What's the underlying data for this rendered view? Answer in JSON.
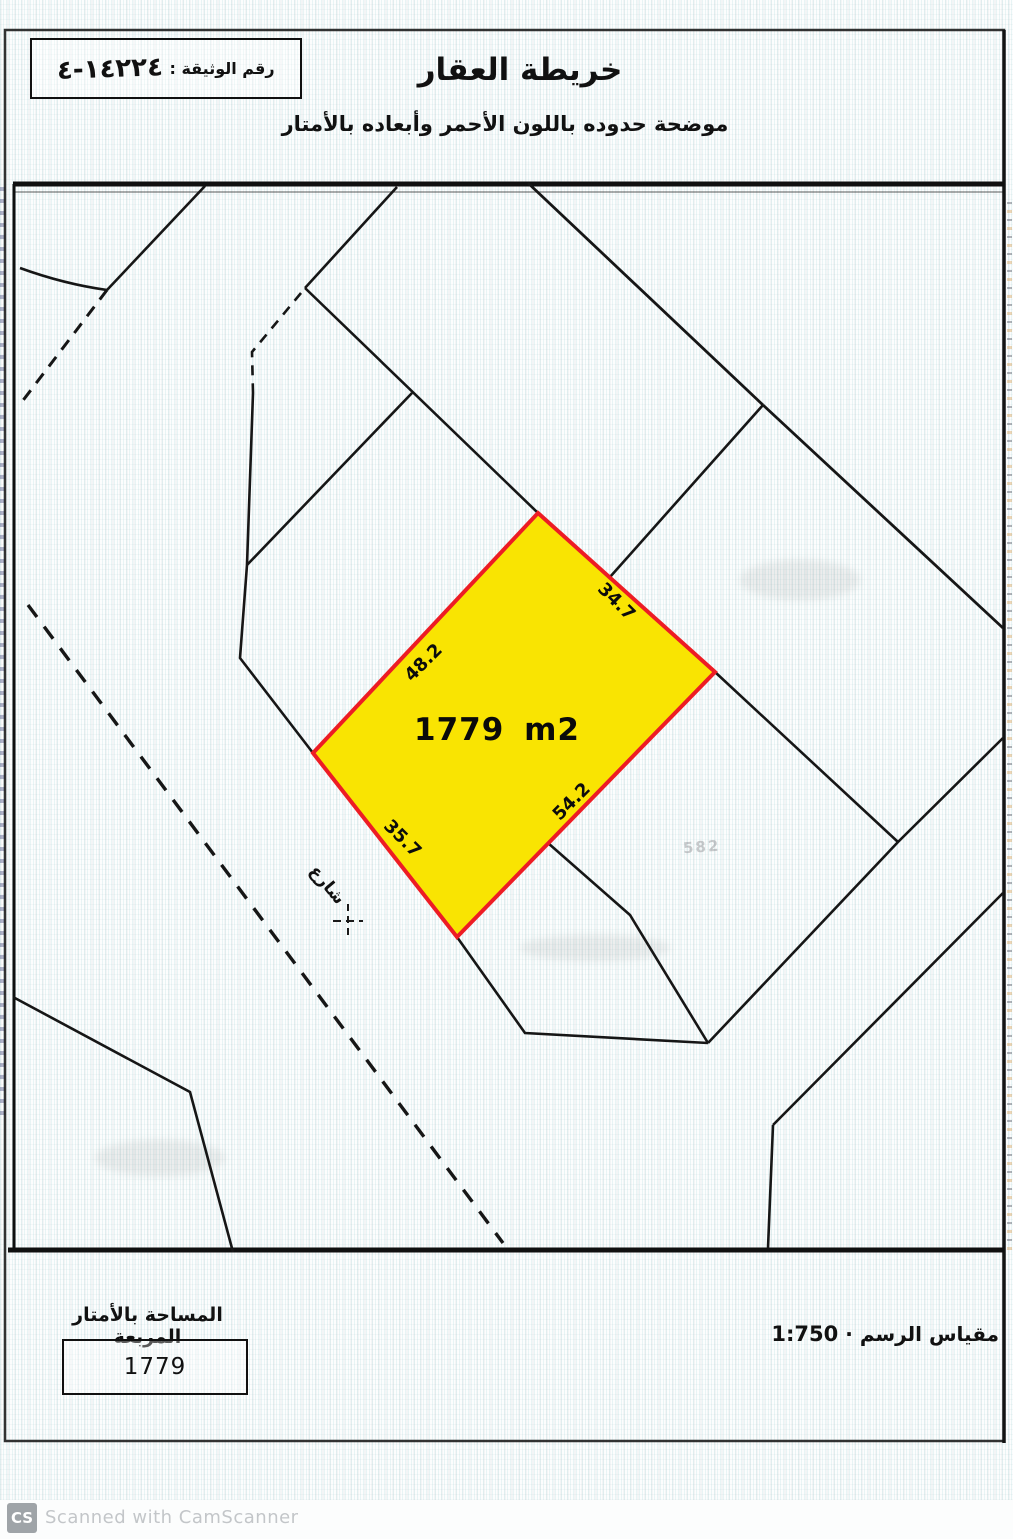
{
  "header": {
    "doc_number_label": "رقم الوثيقة :",
    "doc_number_value": "١٤٢٢٤-٤",
    "title": "خريطة العقار",
    "subtitle": "موضحة حدوده باللون الأحمر وأبعاده بالأمتار"
  },
  "map": {
    "parcel": {
      "area_text": "1779 m2",
      "side_nw": "48.2",
      "side_ne": "34.7",
      "side_se": "54.2",
      "side_sw": "35.7",
      "fill": "#f9e402",
      "stroke": "#ed1c24"
    },
    "street_label": "شارع",
    "bleed_label": "582",
    "line_color": "#161616"
  },
  "footer": {
    "area_label": "المساحة بالأمتار المربعة",
    "area_value": "1779",
    "scale_label": "مقياس الرسم",
    "scale_separator": "·",
    "scale_value": "1:750"
  },
  "watermark": {
    "icon": "CS",
    "text": "Scanned with CamScanner"
  }
}
